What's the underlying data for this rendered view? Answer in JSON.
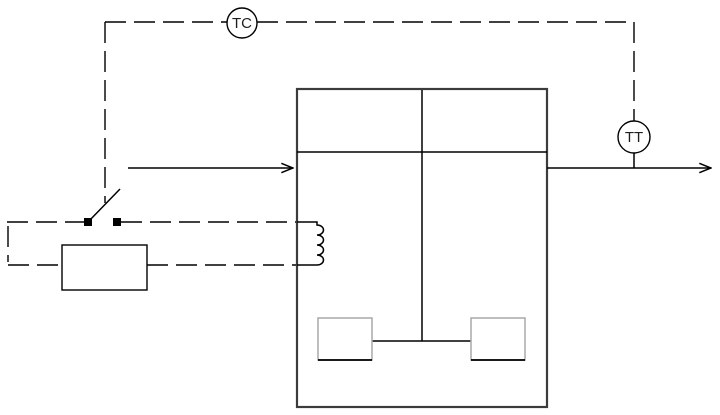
{
  "diagram": {
    "instruments": {
      "controller_label": "TC",
      "transmitter_label": "TT"
    },
    "colors": {
      "line": "#000000",
      "tank_wall": "#3c3c3c",
      "paddle_edge": "#a8a8a8",
      "background": "#ffffff"
    }
  }
}
